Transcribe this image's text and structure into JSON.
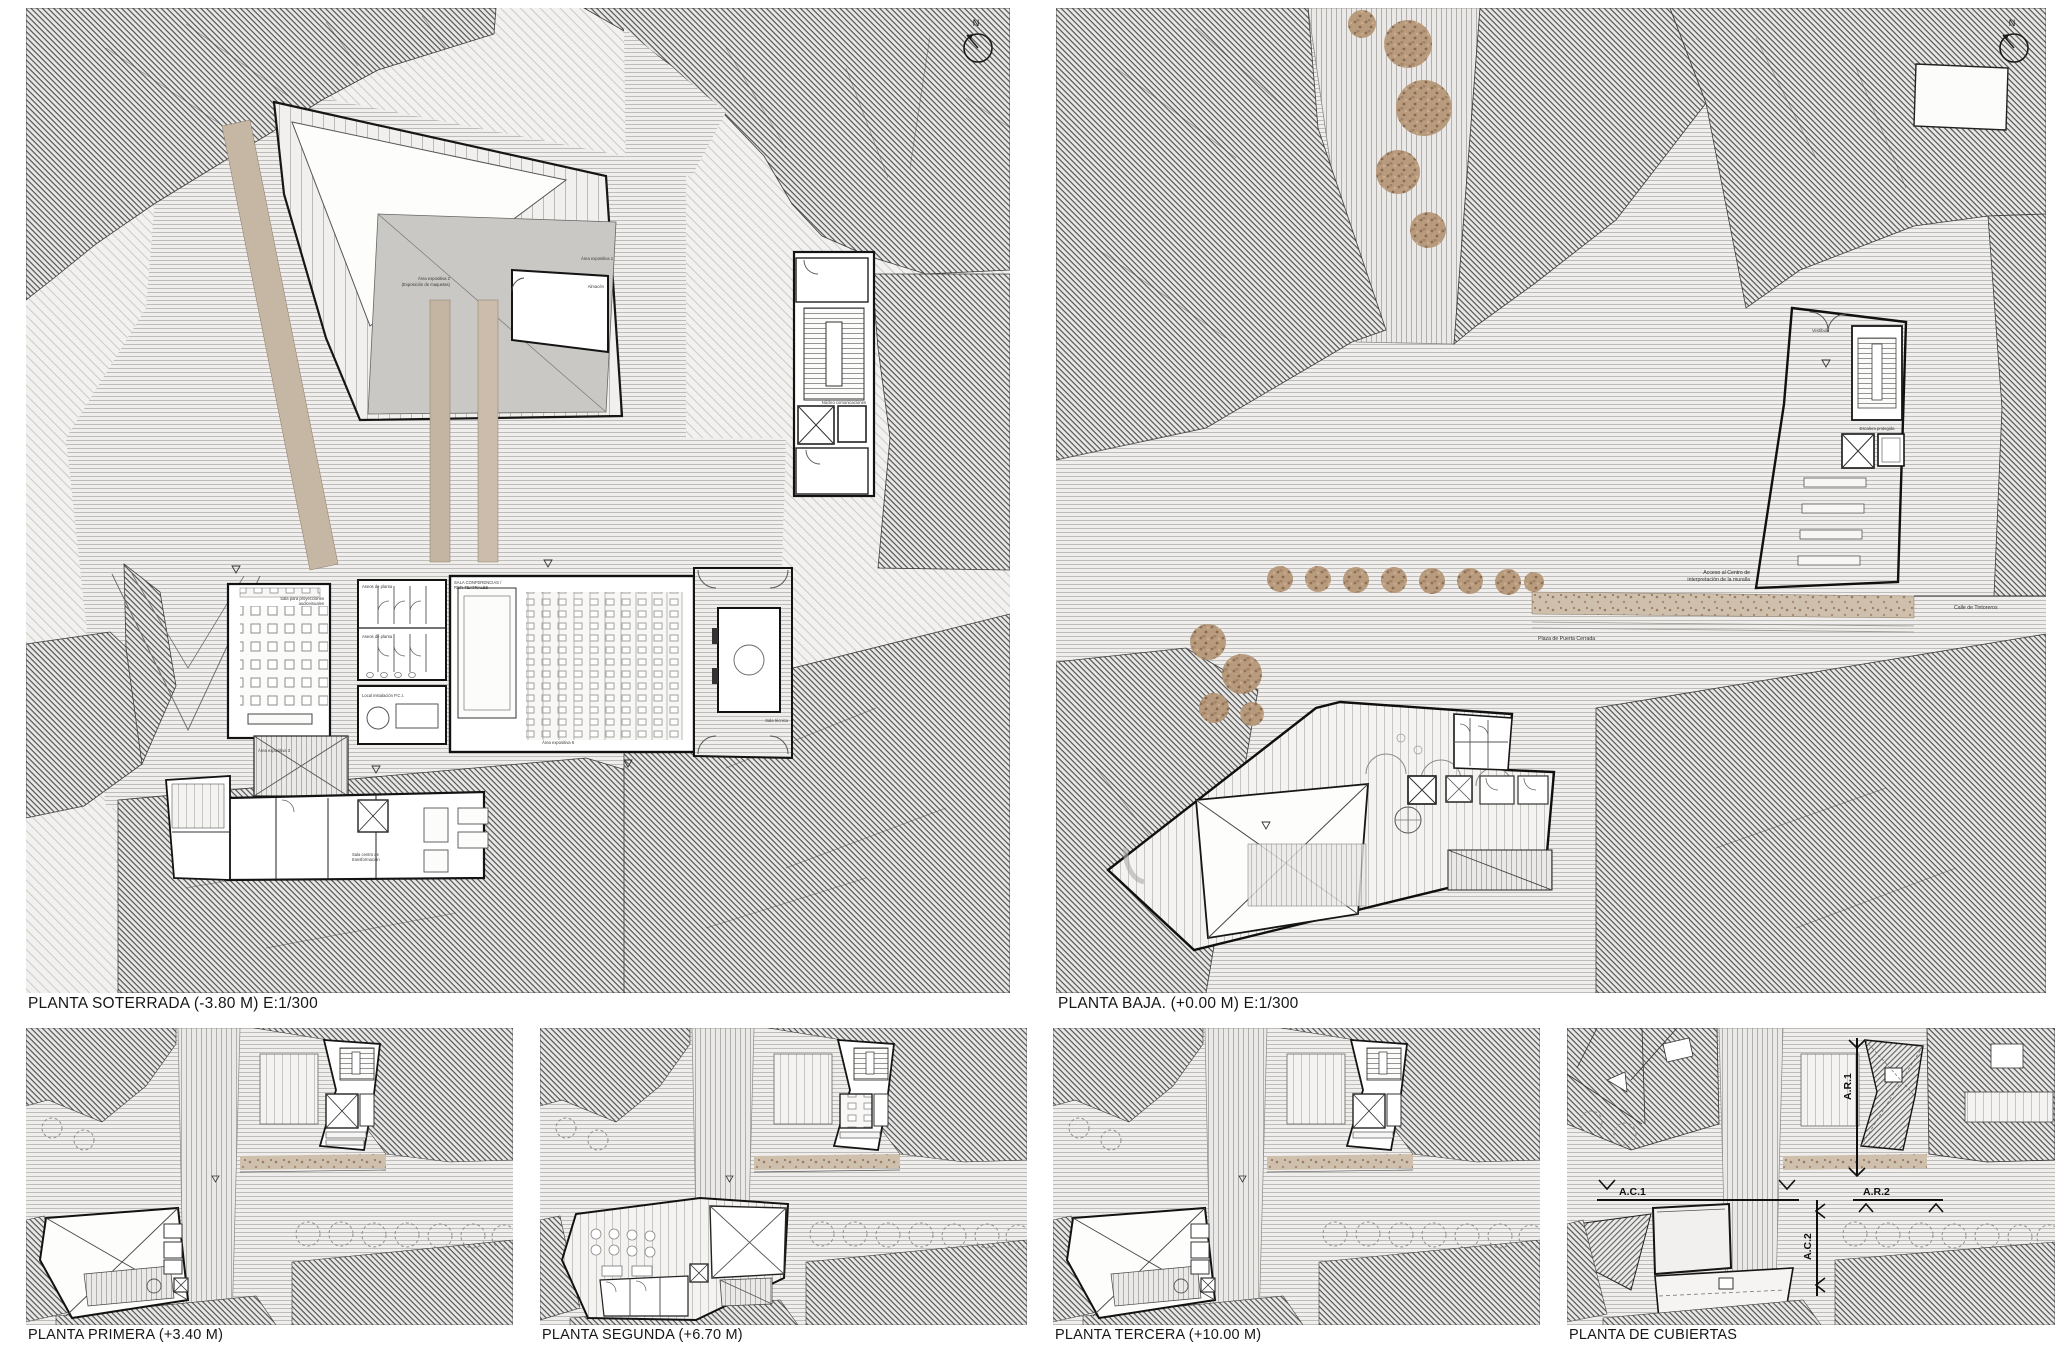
{
  "sheet": {
    "background": "#ffffff"
  },
  "panels": {
    "soterrada": {
      "title": "PLANTA SOTERRADA (-3.80 M) E:1/300",
      "compass_label": "N",
      "labels": {
        "area_expositiva_1": "Área expositiva 1",
        "area_expositiva_2_line1": "Área expositiva 2",
        "area_expositiva_2_line2": "(Exposición de maquetas)",
        "area_expositiva_3": "Área expositiva 3",
        "area_expositiva_6": "Área expositiva 6",
        "almacen": "Almacén",
        "sala_proyecciones_line1": "Sala para proyecciones",
        "sala_proyecciones_line2": "audiovisuales",
        "aseos_planta_1": "Aseos de planta",
        "aseos_planta_2": "Aseos de planta",
        "local_pci": "Local instalación P.C.I.",
        "sala_conferencias_line1": "SALA CONFERENCIAS /",
        "sala_conferencias_line2": "REP. TEATRALES",
        "sala_tecnica": "Sala técnica",
        "nucleo_comunicaciones": "Núcleo comunicaciones",
        "sala_transformacion_line1": "Sala centro de",
        "sala_transformacion_line2": "transformación"
      }
    },
    "baja": {
      "title": "PLANTA BAJA. (+0.00 M) E:1/300",
      "compass_label": "N",
      "labels": {
        "acceso_line1": "Acceso al Centro de",
        "acceso_line2": "interpretación de la muralla",
        "plaza": "Plaza de Puerta Cerrada",
        "calle": "Calle de Tintoreros",
        "escalera": "Escalera protegida",
        "vestibulo": "Vestíbulo"
      }
    },
    "primera": {
      "title": "PLANTA PRIMERA (+3.40 M)"
    },
    "segunda": {
      "title": "PLANTA SEGUNDA (+6.70 M)"
    },
    "tercera": {
      "title": "PLANTA TERCERA (+10.00 M)"
    },
    "cubiertas": {
      "title": "PLANTA DE CUBIERTAS",
      "markers": {
        "ac1": "A.C.1",
        "ar1": "A.R.1",
        "ar2": "A.R.2",
        "ac2": "A.C.2"
      }
    }
  },
  "colors": {
    "hatch_dark_line": "#4e4e4e",
    "street_line": "#bdbcb9",
    "beige_wall": "#c4b4a2",
    "vegetation_brown": "#b79878",
    "courtyard_gray": "#c9c8c5",
    "outline_black": "#111111"
  }
}
